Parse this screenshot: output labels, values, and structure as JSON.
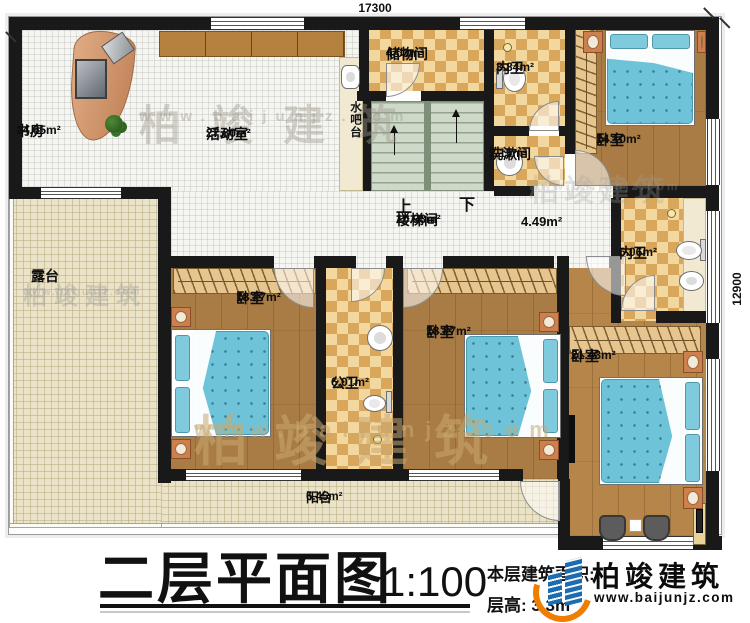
{
  "dimensions": {
    "top": "17300",
    "right": "12900"
  },
  "footer": {
    "title": "二层平面图",
    "scale": "1:100",
    "area_note": "本层建筑面积:",
    "floor_height": "层高: 3.3m"
  },
  "logo": {
    "name": "柏竣建筑",
    "url": "www.baijunjz.com"
  },
  "watermark": {
    "name": "柏竣建筑",
    "url": "www.baijunjz.com"
  },
  "stairs": {
    "up": "上",
    "down": "下",
    "label": "楼梯间",
    "area": "10.98m²"
  },
  "rooms": {
    "study": {
      "label": "书房",
      "area": "14.65m²"
    },
    "activity": {
      "label": "活动室",
      "area": "27.80m²"
    },
    "water_bar": {
      "label": "水吧台"
    },
    "storage": {
      "label": "储物间",
      "area": "4.03m²"
    },
    "bath_top": {
      "label": "内卫",
      "area": "3.84m²"
    },
    "wash_room": {
      "label": "洗漱间",
      "area": "2.15m²"
    },
    "bedroom_ne": {
      "label": "卧室",
      "area": "14.10m²"
    },
    "hall": {
      "area": "4.49m²"
    },
    "bath_east": {
      "label": "内卫",
      "area": "6.06m²"
    },
    "terrace": {
      "label": "露台"
    },
    "bedroom_w": {
      "label": "卧室",
      "area": "18.27m²"
    },
    "bath_public": {
      "label": "公卫",
      "area": "6.01m²"
    },
    "bedroom_mid": {
      "label": "卧室",
      "area": "18.27m²"
    },
    "bedroom_se": {
      "label": "卧室",
      "area": "21.43m²"
    },
    "balcony": {
      "label": "阳台",
      "area": "6.45m²"
    }
  },
  "palette": {
    "wall": "#191919",
    "wood": "#a97c45",
    "tile_dark": "#d9a75c",
    "tile_light": "#f2d89f",
    "cream_floor": "#ebe3c8",
    "stair": "#cfd9c9",
    "bed_blue": "#6fc3d8",
    "logo_blue": "#1d6cb2",
    "logo_orange": "#ef7d00"
  }
}
